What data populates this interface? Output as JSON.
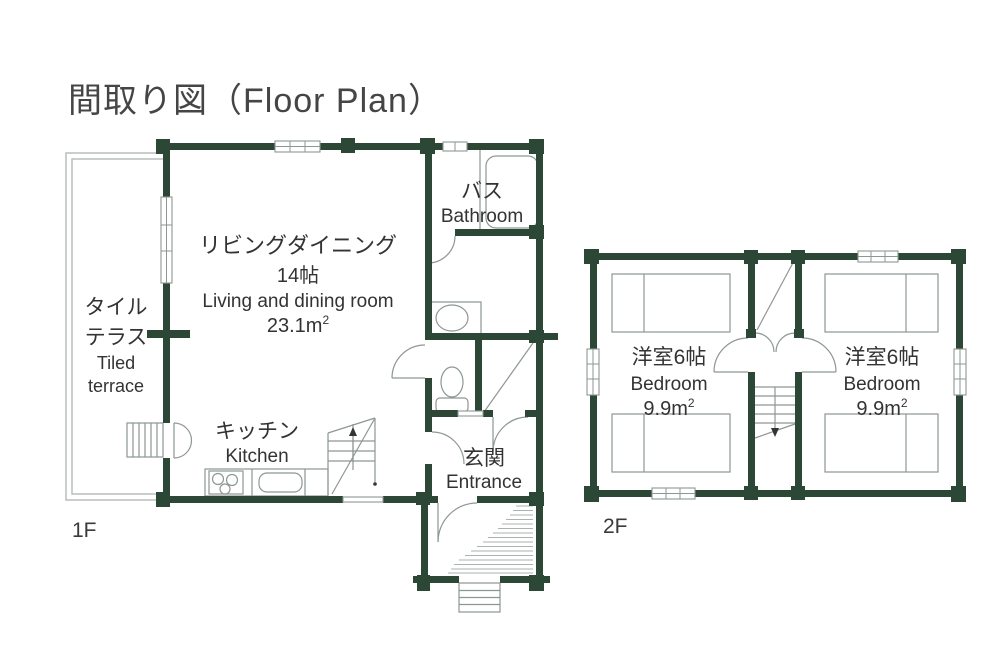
{
  "title": "間取り図（Floor Plan）",
  "floors": {
    "f1": {
      "label": "1F",
      "rooms": {
        "terrace": {
          "jp_line1": "タイル",
          "jp_line2": "テラス",
          "en_line1": "Tiled",
          "en_line2": "terrace"
        },
        "living": {
          "jp": "リビングダイニング",
          "size": "14帖",
          "en": "Living and dining room",
          "area_value": "23.1m",
          "area_sup": "2"
        },
        "kitchen": {
          "jp": "キッチン",
          "en": "Kitchen"
        },
        "bathroom": {
          "jp": "バス",
          "en": "Bathroom"
        },
        "entrance": {
          "jp": "玄関",
          "en": "Entrance"
        }
      }
    },
    "f2": {
      "label": "2F",
      "rooms": {
        "bedroom_left": {
          "jp": "洋室6帖",
          "en": "Bedroom",
          "area_value": "9.9m",
          "area_sup": "2"
        },
        "bedroom_right": {
          "jp": "洋室6帖",
          "en": "Bedroom",
          "area_value": "9.9m",
          "area_sup": "2"
        }
      }
    }
  },
  "colors": {
    "wall": "#2d4737",
    "fixture": "#8d9793",
    "hatch": "#aab3af",
    "terrace": "#b8bdbb",
    "textmain": "#454545",
    "textroom": "#333333"
  }
}
